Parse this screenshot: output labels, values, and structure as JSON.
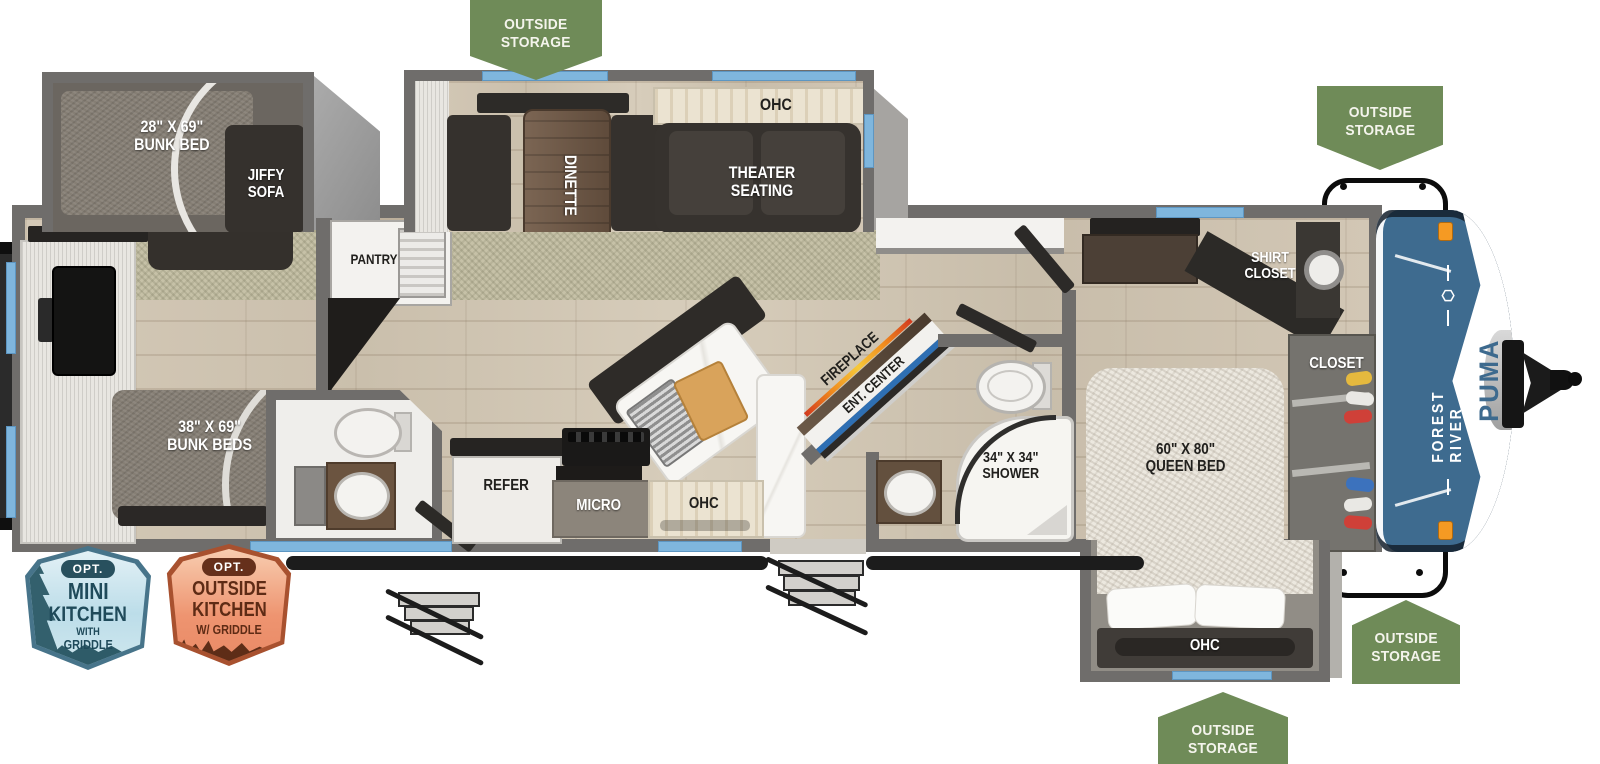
{
  "brand": {
    "maker": "FOREST RIVER",
    "model": "PUMA"
  },
  "storage_badge": "OUTSIDE STORAGE",
  "rooms": {
    "bunk28": {
      "size": "28\" X 69\"",
      "label": "BUNK BED"
    },
    "jiffy_sofa": "JIFFY SOFA",
    "bunks38": {
      "size": "38\" X 69\"",
      "label": "BUNK BEDS"
    },
    "pantry": "PANTRY",
    "dinette": "DINETTE",
    "theater_ohc": "OHC",
    "theater": "THEATER SEATING",
    "fireplace": "FIREPLACE",
    "ent_center": "ENT. CENTER",
    "shower": {
      "size": "34\" X 34\"",
      "label": "SHOWER"
    },
    "shirt_closet": "SHIRT CLOSET",
    "closet": "CLOSET",
    "queen": {
      "size": "60\" X 80\"",
      "label": "QUEEN BED"
    },
    "refer": "REFER",
    "micro": "MICRO",
    "kitchen_ohc": "OHC",
    "bed_ohc": "OHC"
  },
  "options": {
    "mini_kitchen": {
      "opt": "OPT.",
      "line1": "MINI",
      "line2": "KITCHEN",
      "line3": "WITH",
      "line4": "GRIDDLE"
    },
    "outside_kitchen": {
      "opt": "OPT.",
      "line1": "OUTSIDE",
      "line2": "KITCHEN",
      "line3": "W/ GRIDDLE"
    }
  },
  "colors": {
    "badge_green": "#6f8b58",
    "wall_gray": "#6f6d6b",
    "window_blue": "#7fb6dd",
    "cap_blue": "#3e6b8f",
    "flame_orange": "#f08a1d",
    "ent_blue": "#2e6fb3",
    "mini_kitchen_teal": "#1d4f60",
    "outside_kitchen_rust": "#5e2b15"
  }
}
